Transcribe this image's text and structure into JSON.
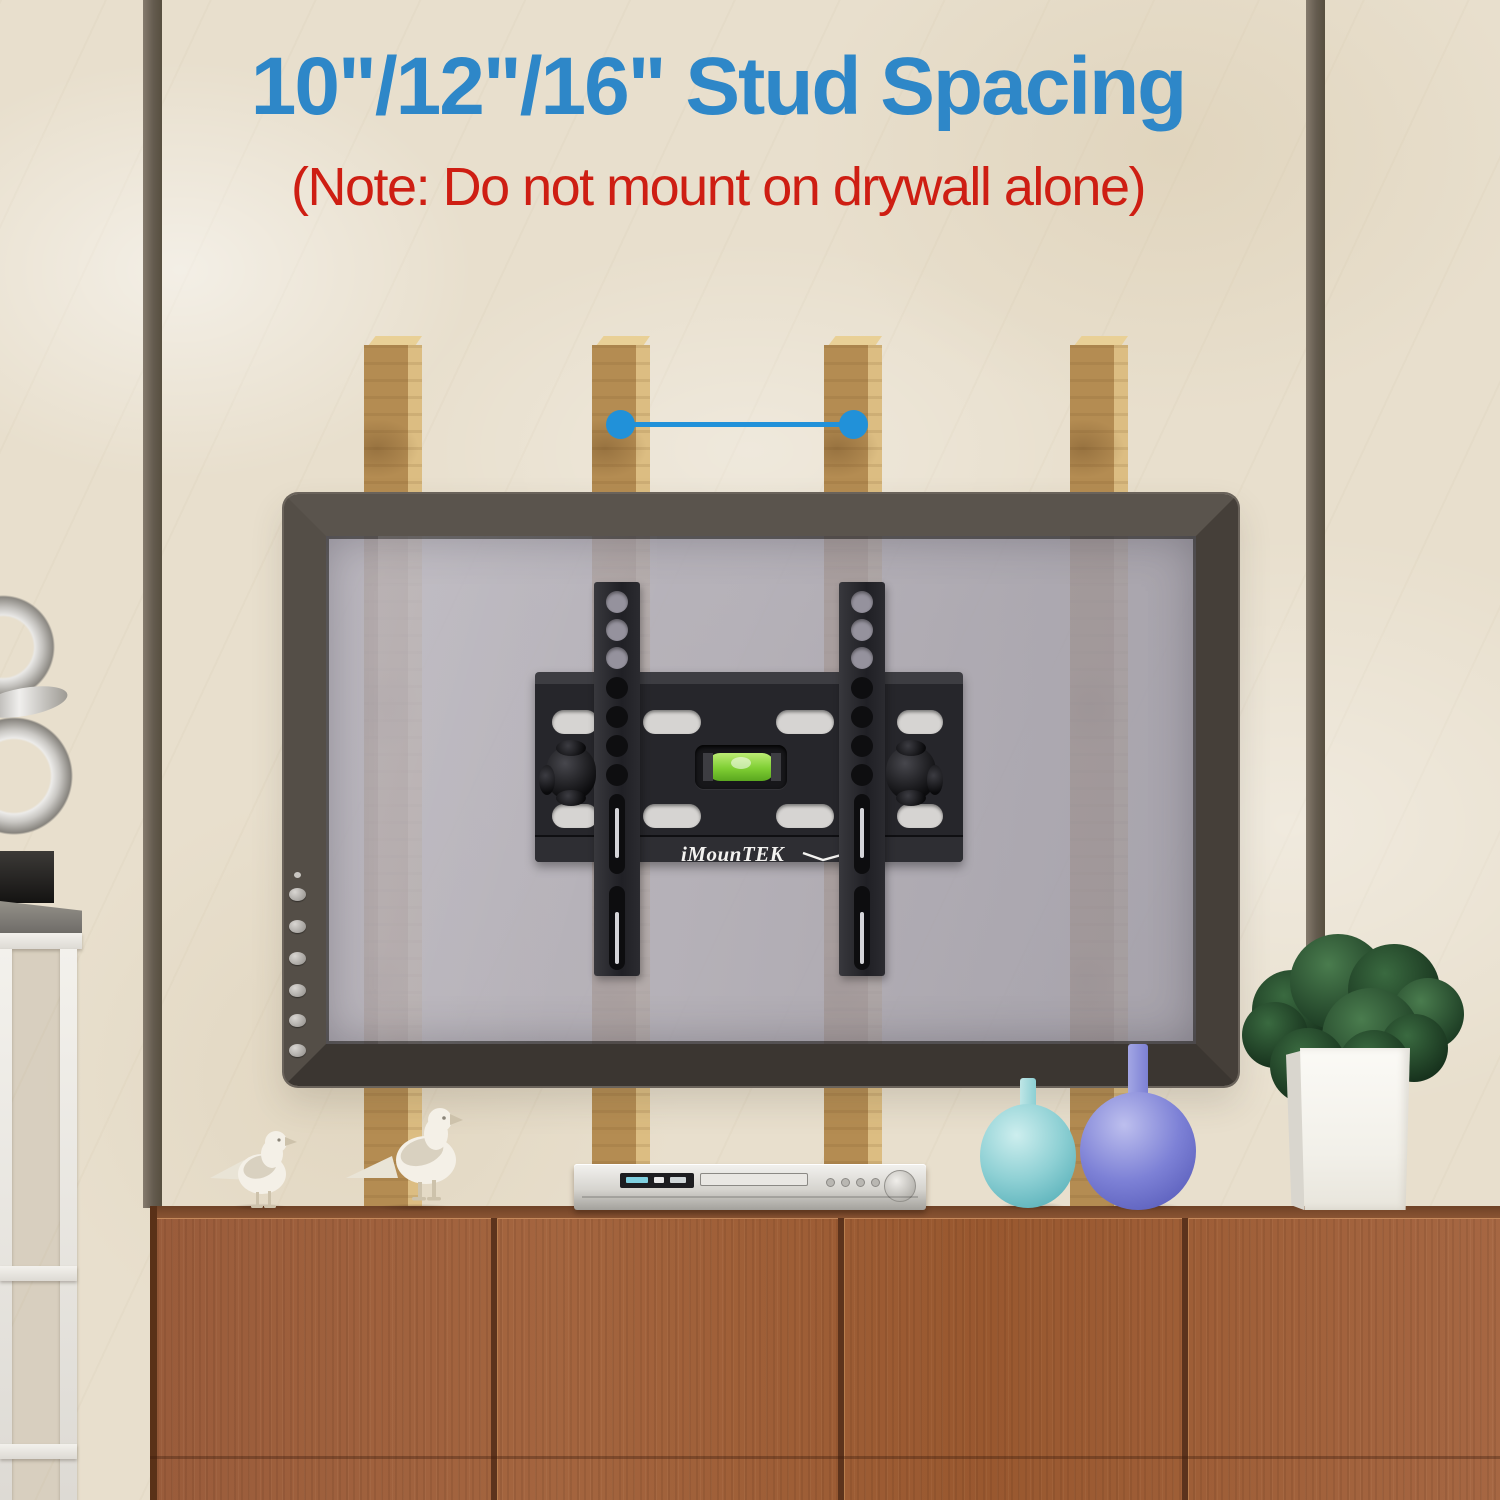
{
  "header": {
    "title": "10\"/12\"/16\" Stud Spacing",
    "note": "(Note: Do not mount on drywall alone)",
    "title_color": "#2e87c8",
    "note_color": "#ce1e13"
  },
  "mount": {
    "brand_label": "iMounTEK",
    "bracket_color": "#26262b",
    "level_vial_color": "#7fce33"
  },
  "scene": {
    "wall_color": "#e8dfcd",
    "stud_wood_color": "#b48c52",
    "stud_count": 4,
    "spacing_line_color": "#2191d9",
    "tv_frame_color": "#4e4842",
    "tv_screen_tint": "#a8a5b1",
    "cabinet_wood_color": "#9e5f3b",
    "objects": [
      "chrome-sculpture",
      "metal-shelf-unit",
      "dove-figurine-small",
      "dove-figurine-large",
      "dvd-player",
      "teal-vase",
      "purple-vase",
      "white-planter-with-plant"
    ]
  }
}
